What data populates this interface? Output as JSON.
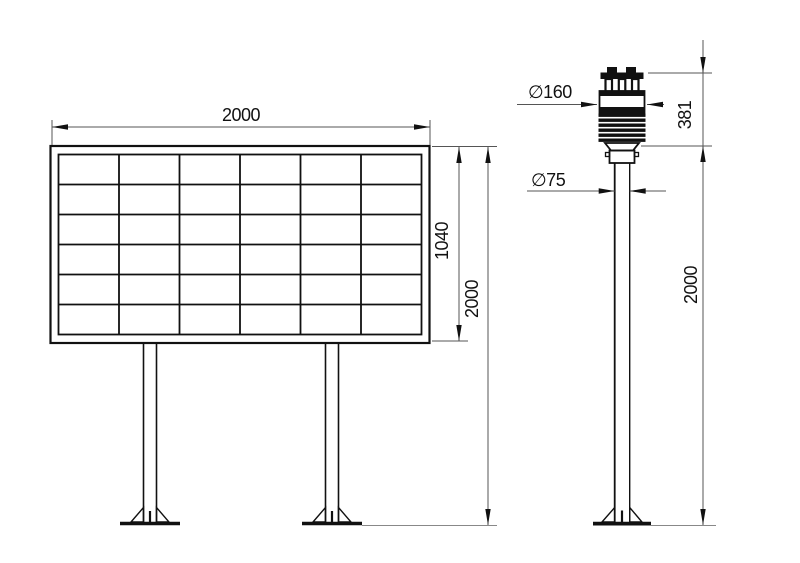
{
  "colors": {
    "background": "#ffffff",
    "line": "#111111",
    "dimension_line": "#555555",
    "ground_line": "#888888"
  },
  "display_board": {
    "grid_rows": 6,
    "grid_cols": 6,
    "dims": {
      "width": "2000",
      "panel_height": "1040",
      "total_height": "2000"
    }
  },
  "weather_station": {
    "dims": {
      "sensor_diameter": "∅160",
      "sensor_height": "381",
      "pole_diameter": "∅75",
      "pole_height": "2000"
    }
  }
}
